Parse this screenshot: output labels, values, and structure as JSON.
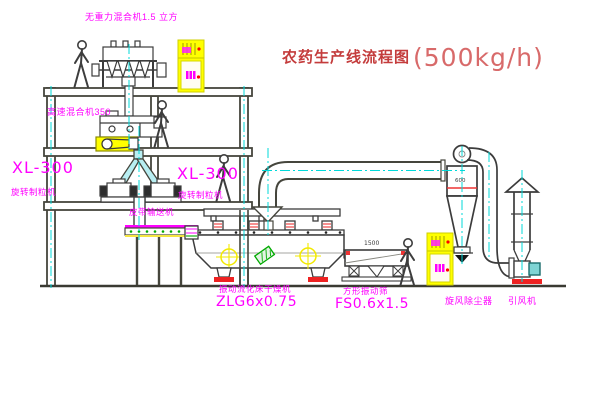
{
  "diagram": {
    "title": {
      "name": "农药生产线流程图",
      "capacity": "(500kg/h)"
    },
    "equipment_labels": {
      "gravity_mixer": "无重力混合机1.5 立方",
      "high_speed_mixer": "高速混合机350",
      "granulator_left_model": "XL-300",
      "granulator_left_name": "旋转制粒机",
      "granulator_right_model": "XL-300",
      "granulator_right_name": "旋转制粒机",
      "belt_conveyor": "皮带输送机",
      "dryer_name": "振动流化床干燥机",
      "dryer_model": "ZLG6x0.75",
      "sieve_name": "方形振动筛",
      "sieve_model": "FS0.6x1.5",
      "sieve_dim": "1500",
      "cyclone_dim": "600",
      "cyclone": "旋风除尘器",
      "induced_draft_fan": "引风机"
    },
    "colors": {
      "label_magenta": "#ff00ff",
      "title_red": "#c43c3c",
      "centerline_cyan": "#00d9d9",
      "highlight_yellow": "#ffff00",
      "structure_gray": "#45453c",
      "accent_red": "#ee2222",
      "accent_green": "#00aa00"
    }
  }
}
